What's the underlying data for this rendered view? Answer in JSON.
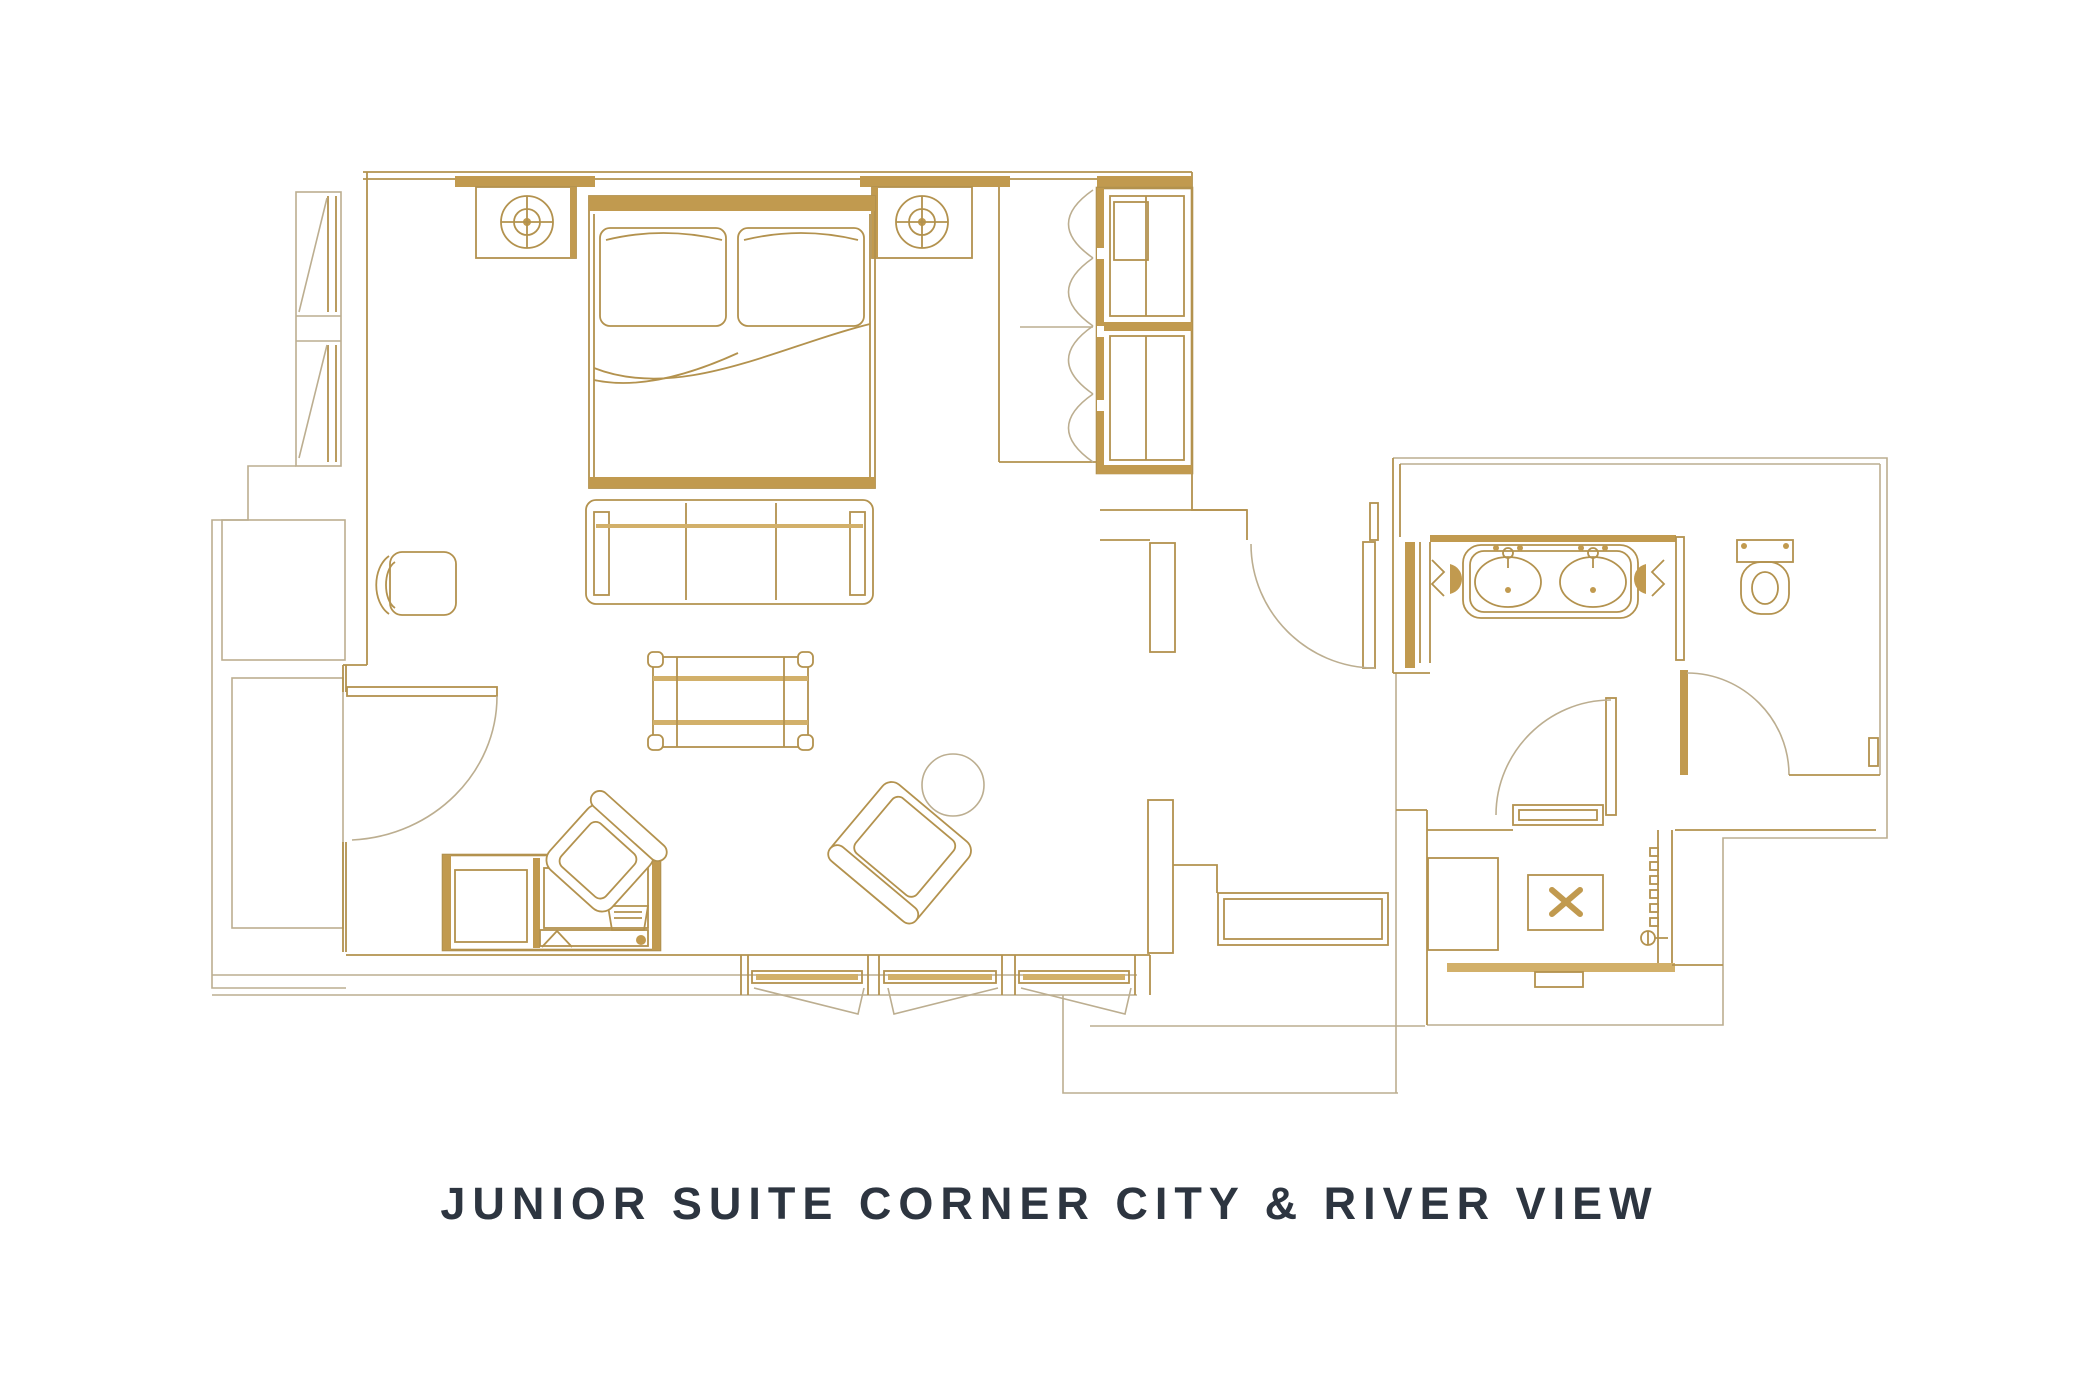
{
  "title": "JUNIOR SUITE CORNER CITY & RIVER VIEW",
  "colors": {
    "background": "#ffffff",
    "line_gold": "#b3924e",
    "fill_gold": "#c19a4f",
    "fill_gold_light": "#d2b06a",
    "pale_outline": "#bcae90",
    "title_color": "#2d3540"
  },
  "plan": {
    "kind": "hotel-suite-floor-plan",
    "rooms": [
      "bedroom-living-area",
      "hallway",
      "vanity-area",
      "toilet-room",
      "shower-room"
    ],
    "furniture_icons": [
      "king-bed",
      "pillow",
      "nightstand",
      "table-lamp",
      "foot-bench",
      "wardrobe",
      "bifold-closet-doors",
      "coffee-table",
      "lounge-armchair",
      "round-side-table",
      "valet-chair",
      "desk-minibar-unit",
      "desk-chair",
      "luggage-console",
      "double-sink-vanity",
      "sink-faucet",
      "toilet",
      "shower-bench",
      "shower-drain",
      "shower-head",
      "glass-screen",
      "window-band",
      "swing-door"
    ]
  }
}
